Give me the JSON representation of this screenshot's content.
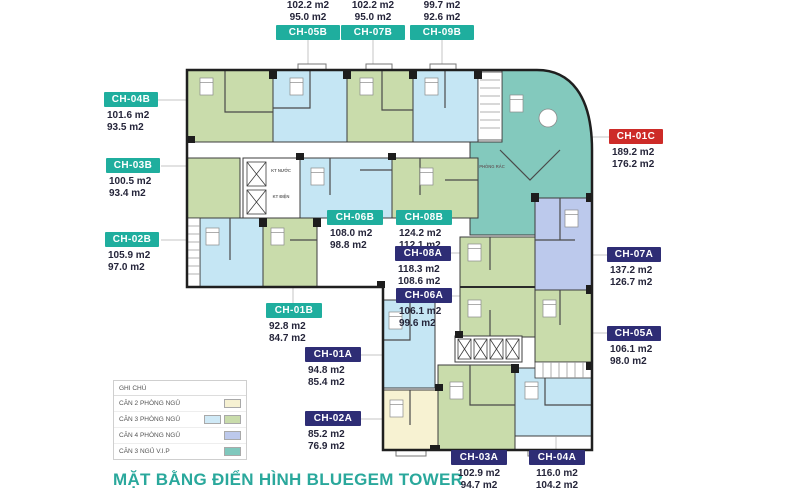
{
  "title": {
    "text": "MẶT BẰNG ĐIỂN HÌNH BLUEGEM TOWER"
  },
  "legend": {
    "header": "GHI CHÚ",
    "rows": [
      {
        "label": "CĂN 2 PHÒNG NGỦ",
        "colors": [
          "#f6f1d2"
        ]
      },
      {
        "label": "CĂN 3 PHÒNG NGỦ",
        "colors": [
          "#cfe9f6",
          "#c9dcab"
        ]
      },
      {
        "label": "CĂN 4 PHÒNG NGỦ",
        "colors": [
          "#bdc9ec"
        ]
      },
      {
        "label": "CĂN 3 NGỦ V.I.P",
        "colors": [
          "#80c8bd"
        ]
      }
    ]
  },
  "plan_annotations": {
    "trash_room": "PHÒNG RÁC",
    "shaft_water": "KT NƯỚC",
    "shaft_electric": "KT ĐIỆN"
  },
  "units": [
    {
      "id": "CH-05B",
      "area_gross": "102.2 m2",
      "area_net": "95.0 m2",
      "label_type": "B"
    },
    {
      "id": "CH-07B",
      "area_gross": "102.2 m2",
      "area_net": "95.0 m2",
      "label_type": "B"
    },
    {
      "id": "CH-09B",
      "area_gross": "99.7 m2",
      "area_net": "92.6 m2",
      "label_type": "B"
    },
    {
      "id": "CH-04B",
      "area_gross": "101.6 m2",
      "area_net": "93.5 m2",
      "label_type": "B"
    },
    {
      "id": "CH-03B",
      "area_gross": "100.5 m2",
      "area_net": "93.4 m2",
      "label_type": "B"
    },
    {
      "id": "CH-02B",
      "area_gross": "105.9 m2",
      "area_net": "97.0 m2",
      "label_type": "B"
    },
    {
      "id": "CH-01C",
      "area_gross": "189.2 m2",
      "area_net": "176.2 m2",
      "label_type": "C"
    },
    {
      "id": "CH-07A",
      "area_gross": "137.2 m2",
      "area_net": "126.7 m2",
      "label_type": "A"
    },
    {
      "id": "CH-05A",
      "area_gross": "106.1 m2",
      "area_net": "98.0 m2",
      "label_type": "A"
    },
    {
      "id": "CH-06B",
      "area_gross": "108.0 m2",
      "area_net": "98.8 m2",
      "label_type": "B"
    },
    {
      "id": "CH-08B",
      "area_gross": "124.2 m2",
      "area_net": "112.1 m2",
      "label_type": "B"
    },
    {
      "id": "CH-08A",
      "area_gross": "118.3 m2",
      "area_net": "108.6 m2",
      "label_type": "A"
    },
    {
      "id": "CH-06A",
      "area_gross": "106.1 m2",
      "area_net": "99.6 m2",
      "label_type": "A"
    },
    {
      "id": "CH-01B",
      "area_gross": "92.8 m2",
      "area_net": "84.7 m2",
      "label_type": "B"
    },
    {
      "id": "CH-01A",
      "area_gross": "94.8 m2",
      "area_net": "85.4 m2",
      "label_type": "A"
    },
    {
      "id": "CH-02A",
      "area_gross": "85.2 m2",
      "area_net": "76.9 m2",
      "label_type": "A"
    },
    {
      "id": "CH-03A",
      "area_gross": "102.9 m2",
      "area_net": "94.7 m2",
      "label_type": "A"
    },
    {
      "id": "CH-04A",
      "area_gross": "116.0 m2",
      "area_net": "104.2 m2",
      "label_type": "A"
    }
  ],
  "colors": {
    "teal_label": "#1fae9e",
    "navy_label": "#2e2d75",
    "red_label": "#cd2b28",
    "title_teal": "#2aa89c",
    "meas_text": "#25253a",
    "unit_green": "#c9dcab",
    "unit_blue": "#c5e6f4",
    "unit_yellow": "#f7f2d2",
    "unit_periwinkle": "#bcc9ec",
    "unit_teal": "#83c9bd",
    "wall": "#2a2a2a",
    "leader": "#c4c4c4"
  }
}
